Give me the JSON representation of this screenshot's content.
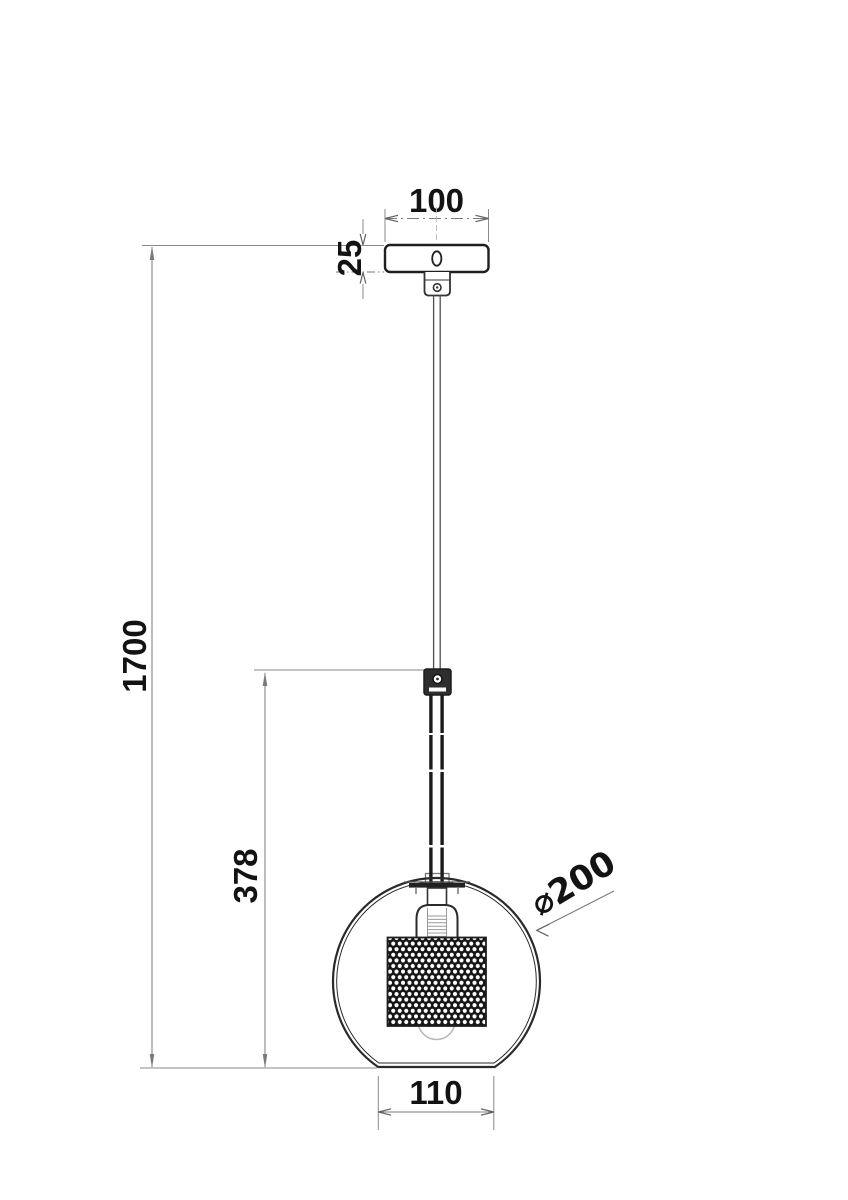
{
  "labels": {
    "canopy_width": "100",
    "canopy_height": "25",
    "overall_height": "1700",
    "cable_drop": "378",
    "shade_diameter": "⌀200",
    "bottom_opening": "110"
  },
  "colors": {
    "background": "#ffffff",
    "outline": "#2a2a2a",
    "dimension_lines": "#7a7a7a",
    "label_text": "#131313",
    "mesh_dark": "#161616"
  }
}
